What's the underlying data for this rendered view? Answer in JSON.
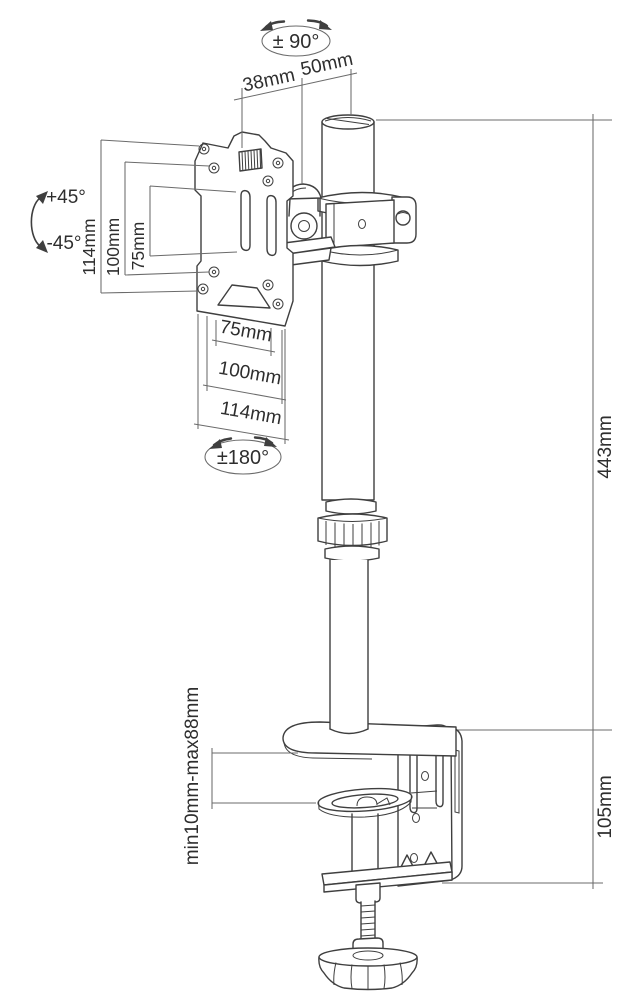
{
  "labels": {
    "rotation_pole": "± 90°",
    "offset_front": "38mm",
    "offset_back": "50mm",
    "tilt_up": "+45°",
    "tilt_down": "-45°",
    "vesa_vertical_outer": "114mm",
    "vesa_vertical_mid": "100mm",
    "vesa_vertical_inner": "75mm",
    "vesa_horizontal_inner": "75mm",
    "vesa_horizontal_mid": "100mm",
    "vesa_horizontal_outer": "114mm",
    "rotation_plate": "±180°",
    "pole_height": "443mm",
    "clamp_bracket_height": "105mm",
    "clamp_grip_range": "min10mm-max88mm"
  },
  "colors": {
    "drawing_line": "#3f3f3f",
    "dimension_line": "#6b6b6b",
    "label_text": "#2e2e2e",
    "background": "#ffffff"
  }
}
